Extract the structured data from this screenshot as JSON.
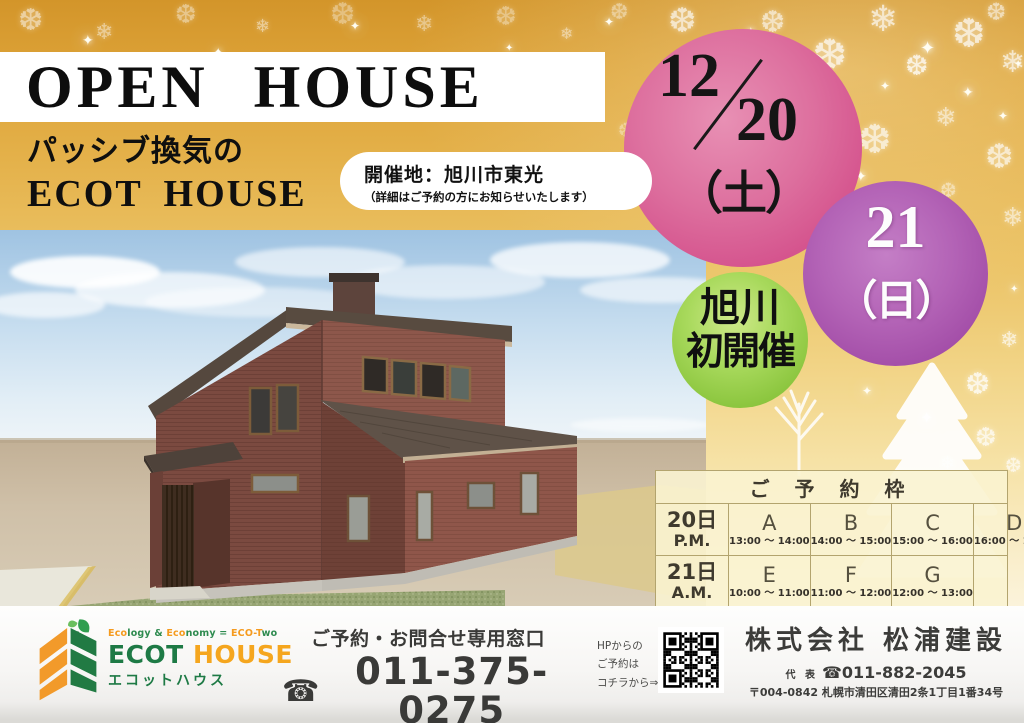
{
  "poster": {
    "title": "OPEN HOUSE",
    "subtitle_line1": "パッシブ換気の",
    "subtitle_line2": "ECOT HOUSE",
    "venue_badge": {
      "line1": "開催地：旭川市東光",
      "line2": "（詳細はご予約の方にお知らせいたします）"
    }
  },
  "dates": {
    "date_sat": {
      "month": "12",
      "day": "20",
      "weekday": "（土）",
      "circle_color": "#d4518c"
    },
    "date_sun": {
      "day": "21",
      "weekday": "（日）",
      "circle_color": "#a855ad"
    },
    "first_badge": {
      "line1": "旭川",
      "line2": "初開催",
      "circle_color": "#8cc63f"
    }
  },
  "reservation": {
    "title": "ご 予 約 枠",
    "rows": [
      {
        "day": "20日",
        "period": "P.M.",
        "slots": [
          {
            "label": "A",
            "time": "13:00 ～ 14:00"
          },
          {
            "label": "B",
            "time": "14:00 ～ 15:00"
          },
          {
            "label": "C",
            "time": "15:00 ～ 16:00"
          },
          {
            "label": "D",
            "time": "16:00 ～ 17:00"
          }
        ]
      },
      {
        "day": "21日",
        "period": "A.M.",
        "slots": [
          {
            "label": "E",
            "time": "10:00 ～ 11:00"
          },
          {
            "label": "F",
            "time": "11:00 ～ 12:00"
          },
          {
            "label": "G",
            "time": "12:00 ～ 13:00"
          },
          {
            "label": "",
            "time": ""
          }
        ]
      }
    ]
  },
  "footer": {
    "logo": {
      "tagline_segments": [
        {
          "text": "Eco",
          "color": "#f59b1e"
        },
        {
          "text": "logy",
          "color": "#2e8b4f"
        },
        {
          "text": " & ",
          "color": "#2e8b4f"
        },
        {
          "text": "Eco",
          "color": "#f59b1e"
        },
        {
          "text": "nomy",
          "color": "#2e8b4f"
        },
        {
          "text": " = ",
          "color": "#2e8b4f"
        },
        {
          "text": "ECO-T",
          "color": "#f59b1e"
        },
        {
          "text": "wo",
          "color": "#2e8b4f"
        }
      ],
      "name_part1": "ECOT",
      "name_part2": "HOUSE",
      "kana": "エコットハウス",
      "green": "#1e7a45",
      "orange": "#f5a61e"
    },
    "contact": {
      "title": "ご予約・お問合せ専用窓口",
      "phone_icon": "☎",
      "phone": "011-375-0275"
    },
    "hp_note": {
      "line1": "HPからの",
      "line2": "ご予約は",
      "line3": "コチラから⇒"
    },
    "company": {
      "name": "株式会社 松浦建設",
      "rep_label": "代 表",
      "rep_phone": "☎011-882-2045",
      "address": "〒004-0842 札幌市清田区清田2条1丁目1番34号"
    }
  },
  "decorations": {
    "snowflake_glyph": "❆",
    "snowflake_glyph2": "❄",
    "sparkle_glyph": "✦"
  }
}
